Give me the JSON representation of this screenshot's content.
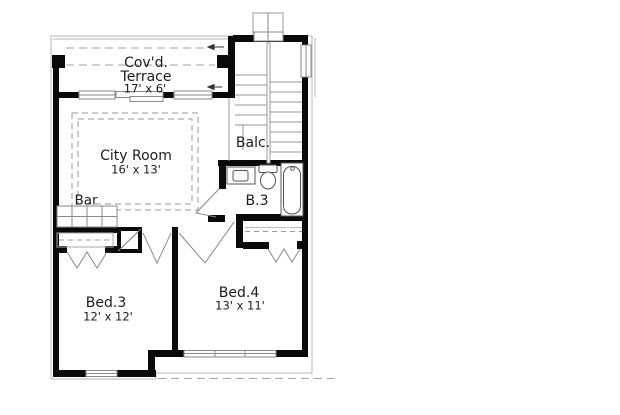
{
  "title": "Second floor plan",
  "rooms": {
    "terrace": {
      "line1": "Cov'd.",
      "line2": "Terrace",
      "dims": "17' x 6'"
    },
    "city_room": {
      "name": "City Room",
      "dims": "16' x 13'"
    },
    "bar": {
      "name": "Bar"
    },
    "balcony": {
      "name": "Balc."
    },
    "bath": {
      "name": "B.3"
    },
    "bed3": {
      "name": "Bed.3",
      "dims": "12' x 12'"
    },
    "bed4": {
      "name": "Bed.4",
      "dims": "13' x 11'"
    }
  },
  "colors": {
    "wall": "#0a0a0a",
    "thin_line": "#8a8a8a",
    "roof_line": "#b4b4b4",
    "dash_line": "#a0a0a0",
    "text": "#1c1c1c",
    "background": "#ffffff"
  }
}
